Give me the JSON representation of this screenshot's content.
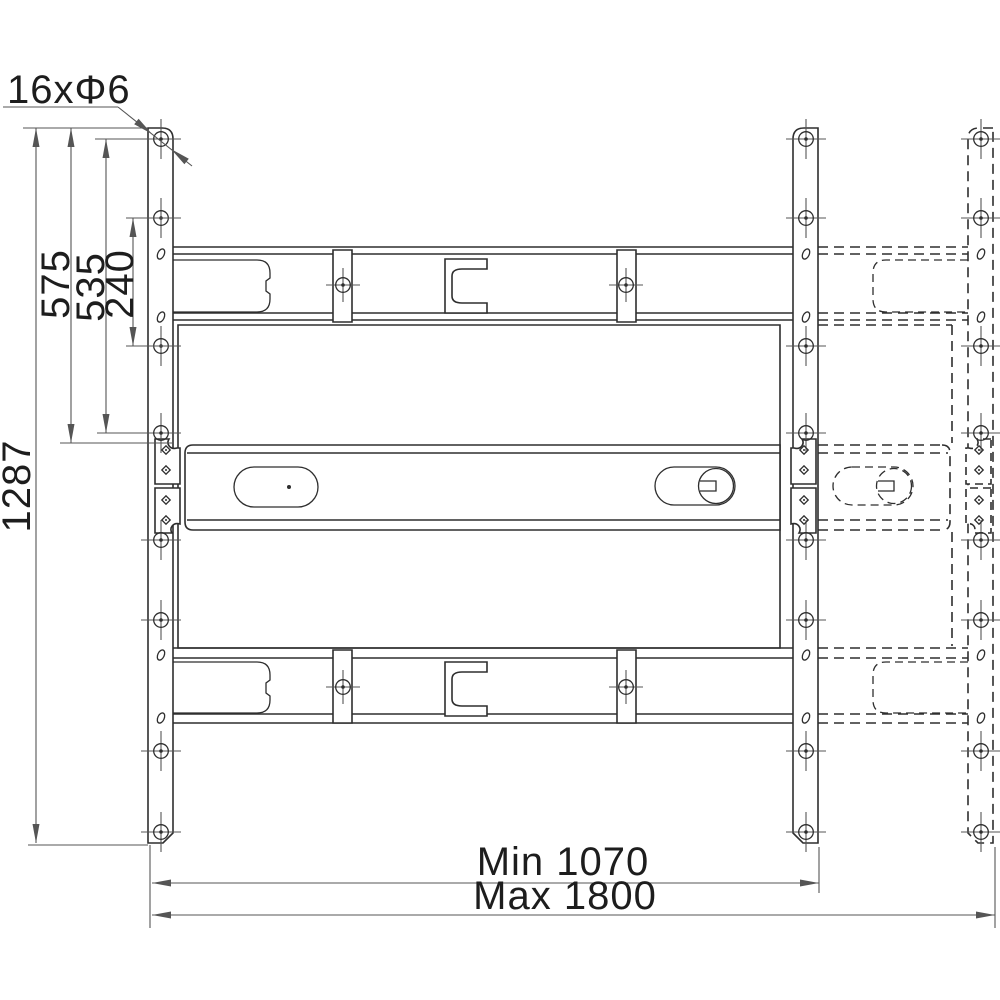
{
  "title": "Wall mount bracket technical drawing",
  "colors": {
    "background": "#ffffff",
    "outline": "#2e2e2e",
    "dimension": "#555555",
    "label": "#1d1d1d"
  },
  "labels": {
    "holes": "16xΦ6",
    "overall_height": "1287",
    "rail_height": "575",
    "hole_span": "535",
    "hole_pitch": "240",
    "width_min": "Min 1070",
    "width_max": "Max 1800"
  },
  "dimensions_shown": {
    "hole_count": 16,
    "hole_diameter": 6,
    "overall_height": 1287,
    "rail_height": 575,
    "hole_span": 535,
    "hole_pitch": 240,
    "min_width": 1070,
    "max_width": 1800
  },
  "geometry": {
    "rails": [
      {
        "cx": 161,
        "style": "solid"
      },
      {
        "cx": 806,
        "style": "solid"
      },
      {
        "cx": 981,
        "style": "dashed"
      }
    ],
    "rail_hole_ys": [
      139,
      218,
      346,
      433,
      540,
      620,
      751,
      832
    ],
    "rail_slot_ys": [
      254,
      317,
      655,
      718
    ],
    "bracket_hole_ys": [
      450,
      470,
      500,
      520
    ],
    "clamp_holes": [
      [
        343,
        285
      ],
      [
        626,
        285
      ],
      [
        343,
        687
      ],
      [
        626,
        687
      ]
    ]
  }
}
